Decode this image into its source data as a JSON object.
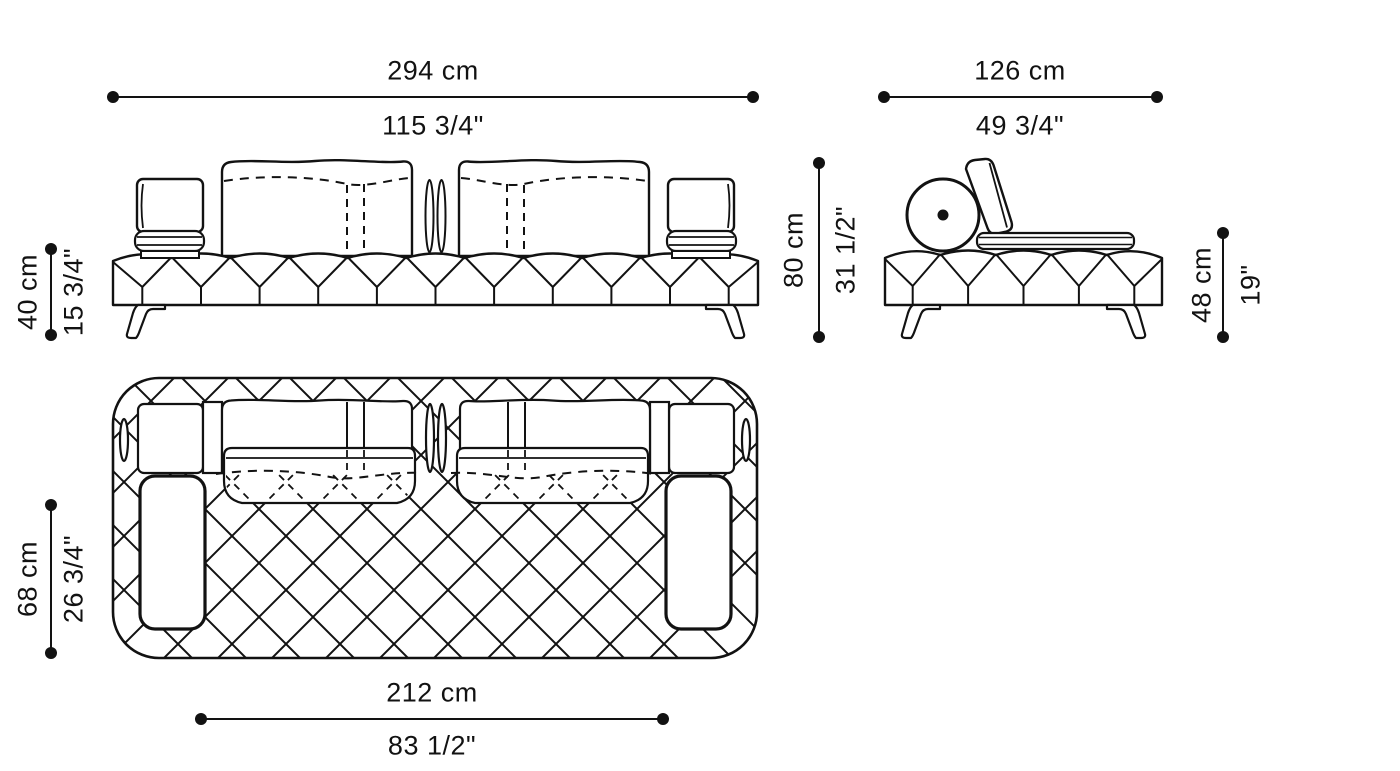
{
  "drawing": {
    "type": "furniture technical drawing",
    "subject": "sofa",
    "views": {
      "front": "front-elevation",
      "side": "side-elevation",
      "top": "plan-view"
    }
  },
  "dimensions": {
    "overall_width": {
      "cm": "294 cm",
      "inches": "115 3/4\""
    },
    "overall_depth": {
      "cm": "126 cm",
      "inches": "49 3/4\""
    },
    "seat_height": {
      "cm": "40 cm",
      "inches": "15 3/4\""
    },
    "overall_height": {
      "cm": "80 cm",
      "inches": "31 1/2\""
    },
    "arm_height": {
      "cm": "48 cm",
      "inches": "19\""
    },
    "cushion_depth": {
      "cm": "68 cm",
      "inches": "26 3/4\""
    },
    "seat_width": {
      "cm": "212 cm",
      "inches": "83 1/2\""
    }
  },
  "colors": {
    "line": "#121212",
    "background": "#ffffff"
  }
}
